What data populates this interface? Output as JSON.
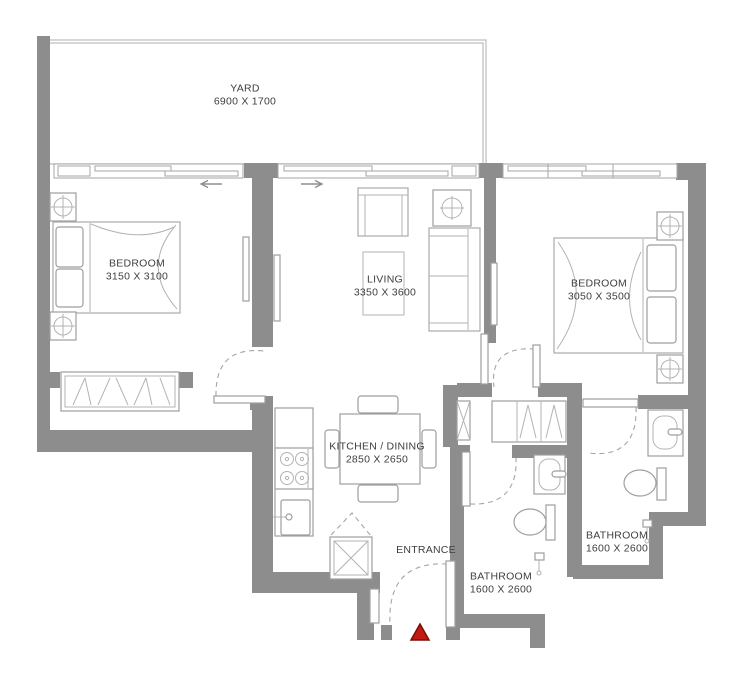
{
  "plan": {
    "colors": {
      "wall": "#8d8d8d",
      "outline": "#a9a9a9",
      "text": "#3e3e3e",
      "entrance_marker": "#c01a12",
      "entrance_marker_border": "#7c0c06"
    },
    "rooms": [
      {
        "id": "yard",
        "name": "YARD",
        "dims": "6900 X 1700"
      },
      {
        "id": "bedroom-left",
        "name": "BEDROOM",
        "dims": "3150 X 3100"
      },
      {
        "id": "living",
        "name": "LIVING",
        "dims": "3350 X 3600"
      },
      {
        "id": "bedroom-right",
        "name": "BEDROOM",
        "dims": "3050 X 3500"
      },
      {
        "id": "kitchen-dining",
        "name": "KITCHEN / DINING",
        "dims": "2850 X 2650"
      },
      {
        "id": "bathroom-center",
        "name": "BATHROOM",
        "dims": "1600 X 2600"
      },
      {
        "id": "bathroom-right",
        "name": "BATHROOM",
        "dims": "1600 X 2600"
      }
    ],
    "entrance": {
      "label": "ENTRANCE"
    }
  }
}
